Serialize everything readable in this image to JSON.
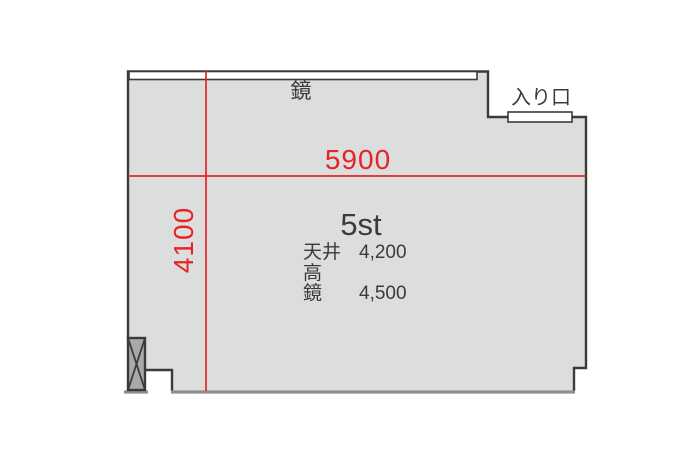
{
  "floor_plan": {
    "studio_name": "5st",
    "width_dimension": "5900",
    "depth_dimension": "4100",
    "mirror_label": "鏡",
    "entrance_label": "入り口",
    "specs": [
      {
        "label": "天井高",
        "value": "4,200"
      },
      {
        "label": "鏡",
        "value": "4,500"
      }
    ],
    "colors": {
      "floor_fill": "#dcdddd",
      "wall_outline": "#3e3a39",
      "bottom_edge": "#8f8f8f",
      "dimension_red": "#e62328",
      "pillar_fill": "#a9a9a9",
      "mirror_fill": "#ffffff"
    }
  }
}
